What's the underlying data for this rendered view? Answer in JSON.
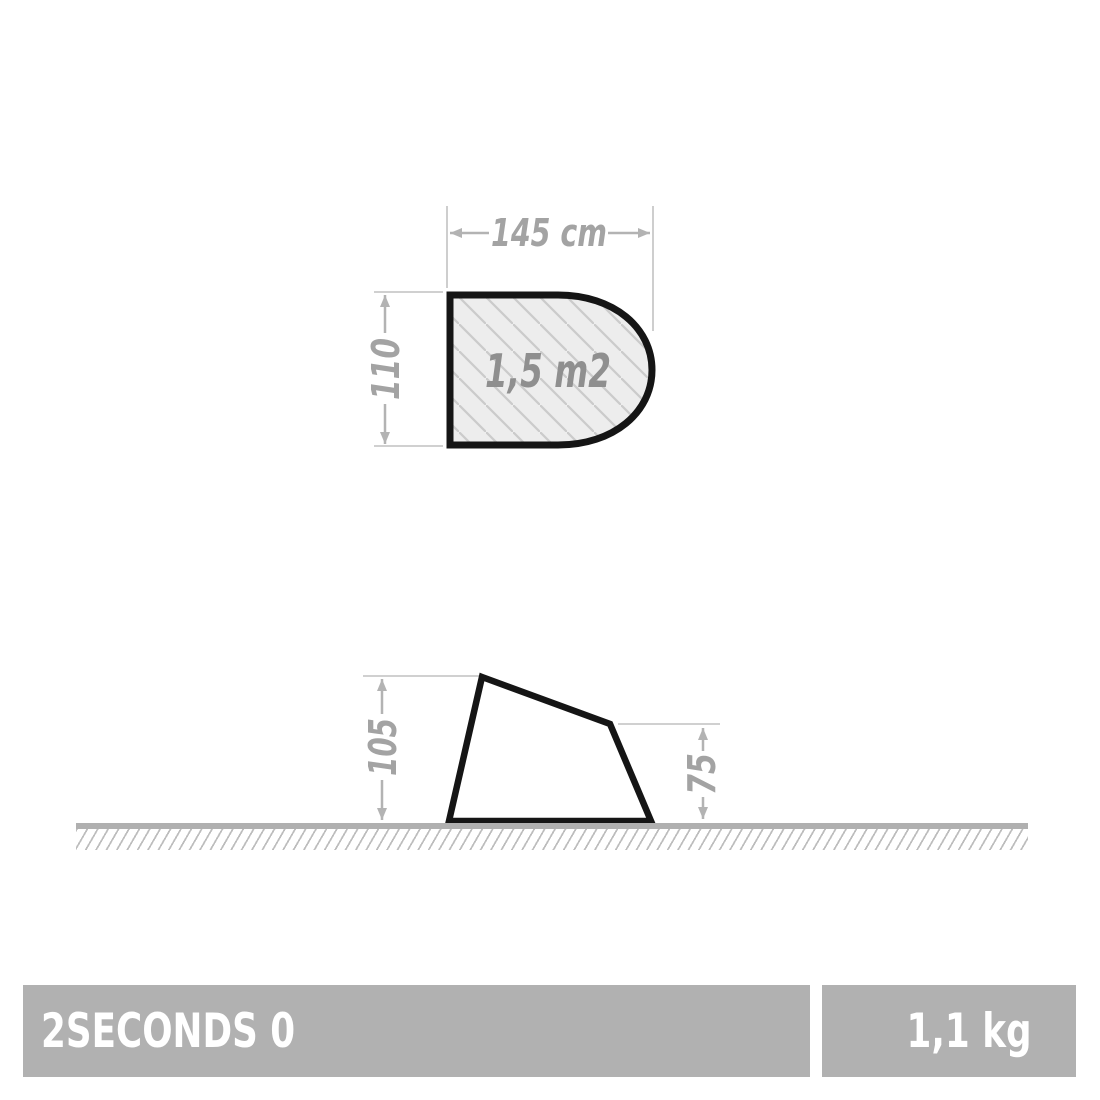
{
  "footprint_diagram": {
    "width_label": "145 cm",
    "width_cm": 145,
    "depth_label": "110",
    "depth_cm": 110,
    "area_label": "1,5 m2",
    "area_m2": 1.5
  },
  "side_diagram": {
    "front_height_label": "105",
    "front_height_cm": 105,
    "rear_height_label": "75",
    "rear_height_cm": 75
  },
  "footer": {
    "product_name": "2SECONDS 0",
    "weight_label": "1,1 kg",
    "weight_kg": 1.1
  },
  "colors": {
    "dimension_text": "#a3a3a3",
    "area_text": "#8f8f8f",
    "dimension_arrow": "#b3b3b3",
    "extension_line": "#c9c9c9",
    "shape_outline": "#151515",
    "footprint_fill": "#ededed",
    "footprint_hatch": "#cbcbcb",
    "ground_solid": "#b0b0b0",
    "ground_hatch": "#bdbdbd",
    "bar_background": "#b1b1b1",
    "bar_text": "#ffffff",
    "page_background": "#ffffff"
  }
}
